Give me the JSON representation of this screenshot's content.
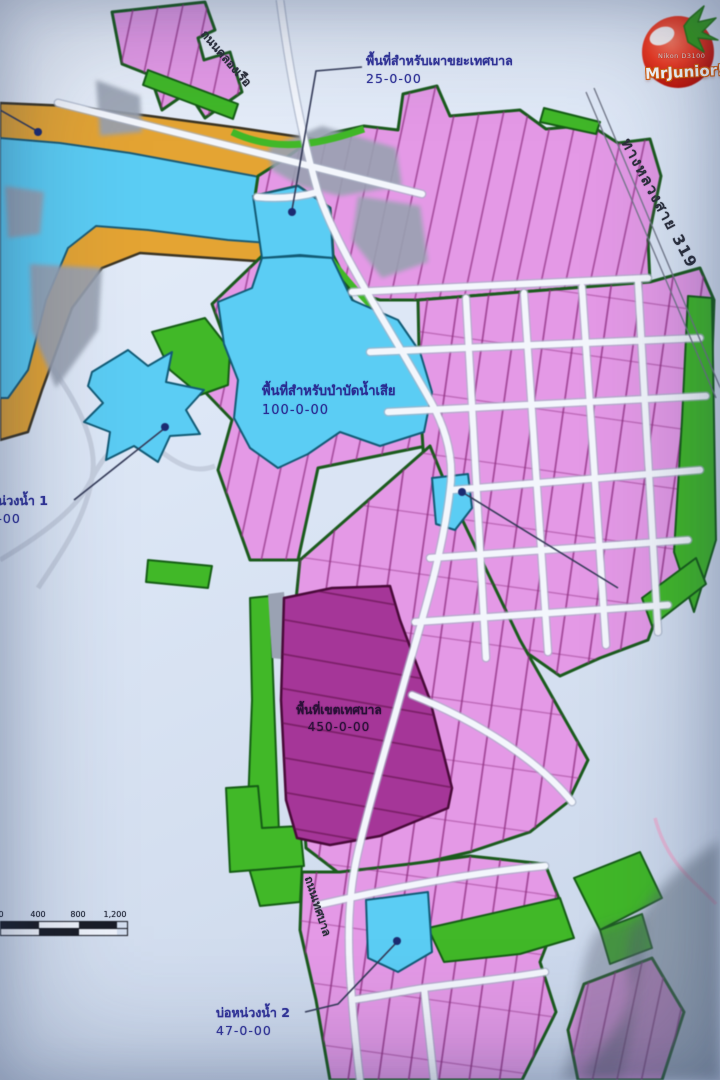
{
  "map": {
    "title": "municipal land-use zoning map (photographed)",
    "annotations": [
      {
        "id": "waste-incinerator-area",
        "text": "พื้นที่สำหรับเผาขยะเทศบาล",
        "area": "25-0-00"
      },
      {
        "id": "wastewater-treatment-area",
        "text": "พื้นที่สำหรับบำบัดน้ำเสีย",
        "area": "100-0-00"
      },
      {
        "id": "retention-pond-1",
        "text": "บ่อหน่วงน้ำ 1",
        "area": "7-0-00"
      },
      {
        "id": "municipal-zone",
        "text": "พื้นที่เขตเทศบาล",
        "area": "450-0-00"
      },
      {
        "id": "retention-pond-2",
        "text": "บ่อหน่วงน้ำ 2",
        "area": "47-0-00"
      }
    ],
    "roads": [
      {
        "id": "highway-319",
        "label": "ทางหลวงสาย 319"
      },
      {
        "id": "road-northwest",
        "label": "ถนนคลองเรือ"
      },
      {
        "id": "road-south",
        "label": "ถนนเทศบาล"
      }
    ],
    "scale_bar": {
      "labels": [
        "0",
        "400",
        "800",
        "1,200"
      ]
    },
    "colors": {
      "paper": "#dde7f6",
      "parcel_pink": "#e29ae4",
      "parcel_line": "#8c2f7e",
      "border_dark_green": "#1c5a1e",
      "strip_green": "#44b72c",
      "water_blue": "#5fccf2",
      "orange_band": "#e2a438",
      "purple_zone": "#a23795",
      "road_white": "#f3f6fc",
      "label_blue": "#31339a"
    }
  },
  "watermark": {
    "camera": "Nikon D3100",
    "name": "MrJunior!"
  }
}
